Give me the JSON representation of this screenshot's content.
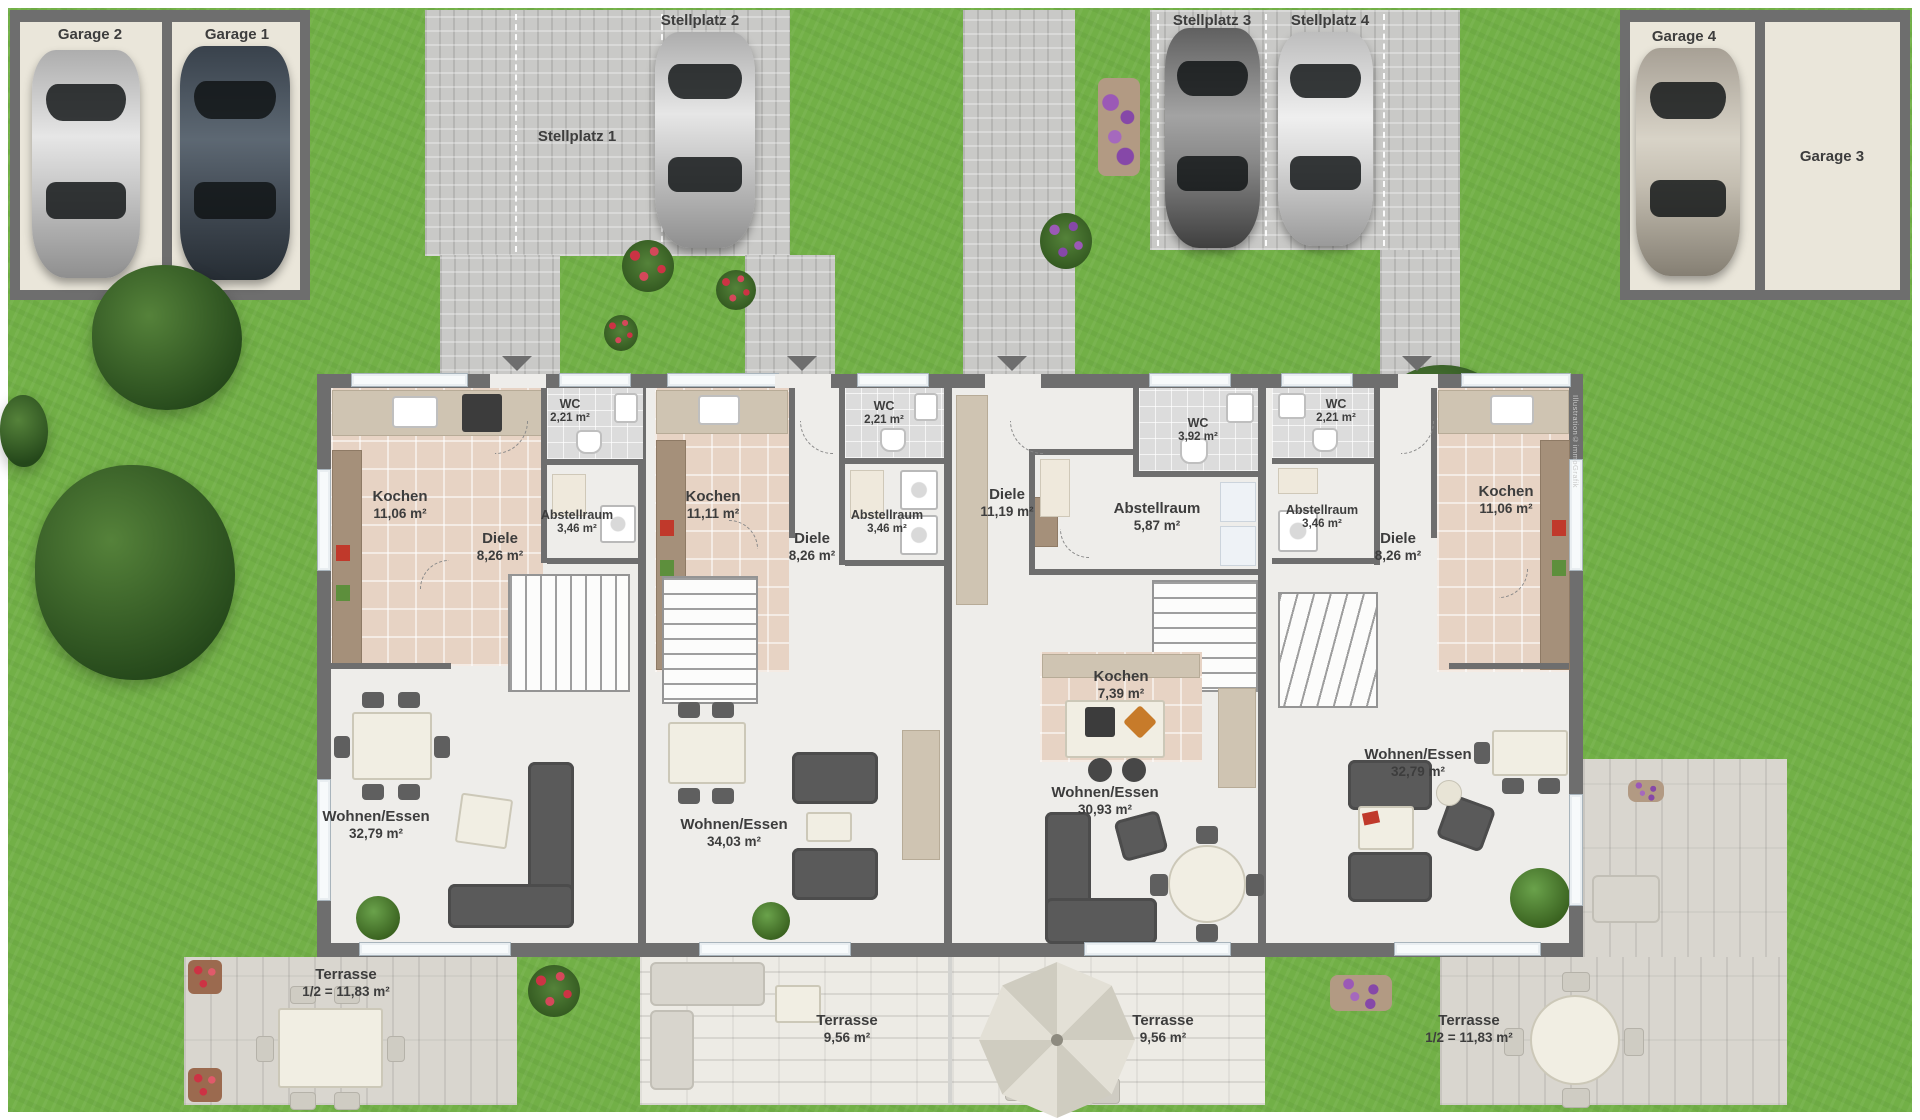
{
  "watermark": "Illustration©immoGrafik",
  "colors": {
    "grass": "#72b047",
    "pavement": "#c9c9c7",
    "wall": "#6e6e6e",
    "garage_floor": "#eae6da",
    "floor": "#eeedea",
    "kitchen_tile": "#e7d3c4",
    "wc_tile": "#dcdcdc",
    "terrace_plank": "#d9d6cf",
    "terrace_brick": "#edebe5",
    "label_text": "#3d3d3d"
  },
  "parking": {
    "garage_2": {
      "label": "Garage 2",
      "occupied": true,
      "car": "silver"
    },
    "garage_1": {
      "label": "Garage 1",
      "occupied": true,
      "car": "dark-blue-gray"
    },
    "garage_4": {
      "label": "Garage 4",
      "occupied": true,
      "car": "beige-silver"
    },
    "garage_3": {
      "label": "Garage 3",
      "occupied": false,
      "car": ""
    },
    "stellplatz_1": {
      "label": "Stellplatz 1",
      "occupied": false,
      "car": ""
    },
    "stellplatz_2": {
      "label": "Stellplatz 2",
      "occupied": true,
      "car": "silver"
    },
    "stellplatz_3": {
      "label": "Stellplatz 3",
      "occupied": true,
      "car": "dark-gray"
    },
    "stellplatz_4": {
      "label": "Stellplatz 4",
      "occupied": true,
      "car": "silver-sport"
    }
  },
  "units": {
    "unit_1": {
      "kochen": {
        "name": "Kochen",
        "area": "11,06 m²"
      },
      "wc": {
        "name": "WC",
        "area": "2,21 m²"
      },
      "abstellraum": {
        "name": "Abstellraum",
        "area": "3,46 m²"
      },
      "diele": {
        "name": "Diele",
        "area": "8,26 m²"
      },
      "wohnen_essen": {
        "name": "Wohnen/Essen",
        "area": "32,79 m²"
      },
      "terrasse": {
        "name": "Terrasse",
        "area": "1/2 = 11,83 m²"
      }
    },
    "unit_2": {
      "kochen": {
        "name": "Kochen",
        "area": "11,11 m²"
      },
      "wc": {
        "name": "WC",
        "area": "2,21 m²"
      },
      "abstellraum": {
        "name": "Abstellraum",
        "area": "3,46 m²"
      },
      "diele": {
        "name": "Diele",
        "area": "8,26 m²"
      },
      "wohnen_essen": {
        "name": "Wohnen/Essen",
        "area": "34,03 m²"
      },
      "terrasse": {
        "name": "Terrasse",
        "area": "9,56 m²"
      }
    },
    "unit_3": {
      "diele": {
        "name": "Diele",
        "area": "11,19 m²"
      },
      "wc": {
        "name": "WC",
        "area": "3,92 m²"
      },
      "abstellraum": {
        "name": "Abstellraum",
        "area": "5,87 m²"
      },
      "kochen": {
        "name": "Kochen",
        "area": "7,39 m²"
      },
      "wohnen_essen": {
        "name": "Wohnen/Essen",
        "area": "30,93 m²"
      },
      "terrasse": {
        "name": "Terrasse",
        "area": "9,56 m²"
      }
    },
    "unit_4": {
      "wc": {
        "name": "WC",
        "area": "2,21 m²"
      },
      "abstellraum": {
        "name": "Abstellraum",
        "area": "3,46 m²"
      },
      "diele": {
        "name": "Diele",
        "area": "8,26 m²"
      },
      "kochen": {
        "name": "Kochen",
        "area": "11,06 m²"
      },
      "wohnen_essen": {
        "name": "Wohnen/Essen",
        "area": "32,79 m²"
      },
      "terrasse": {
        "name": "Terrasse",
        "area": "1/2 = 11,83 m²"
      }
    }
  }
}
